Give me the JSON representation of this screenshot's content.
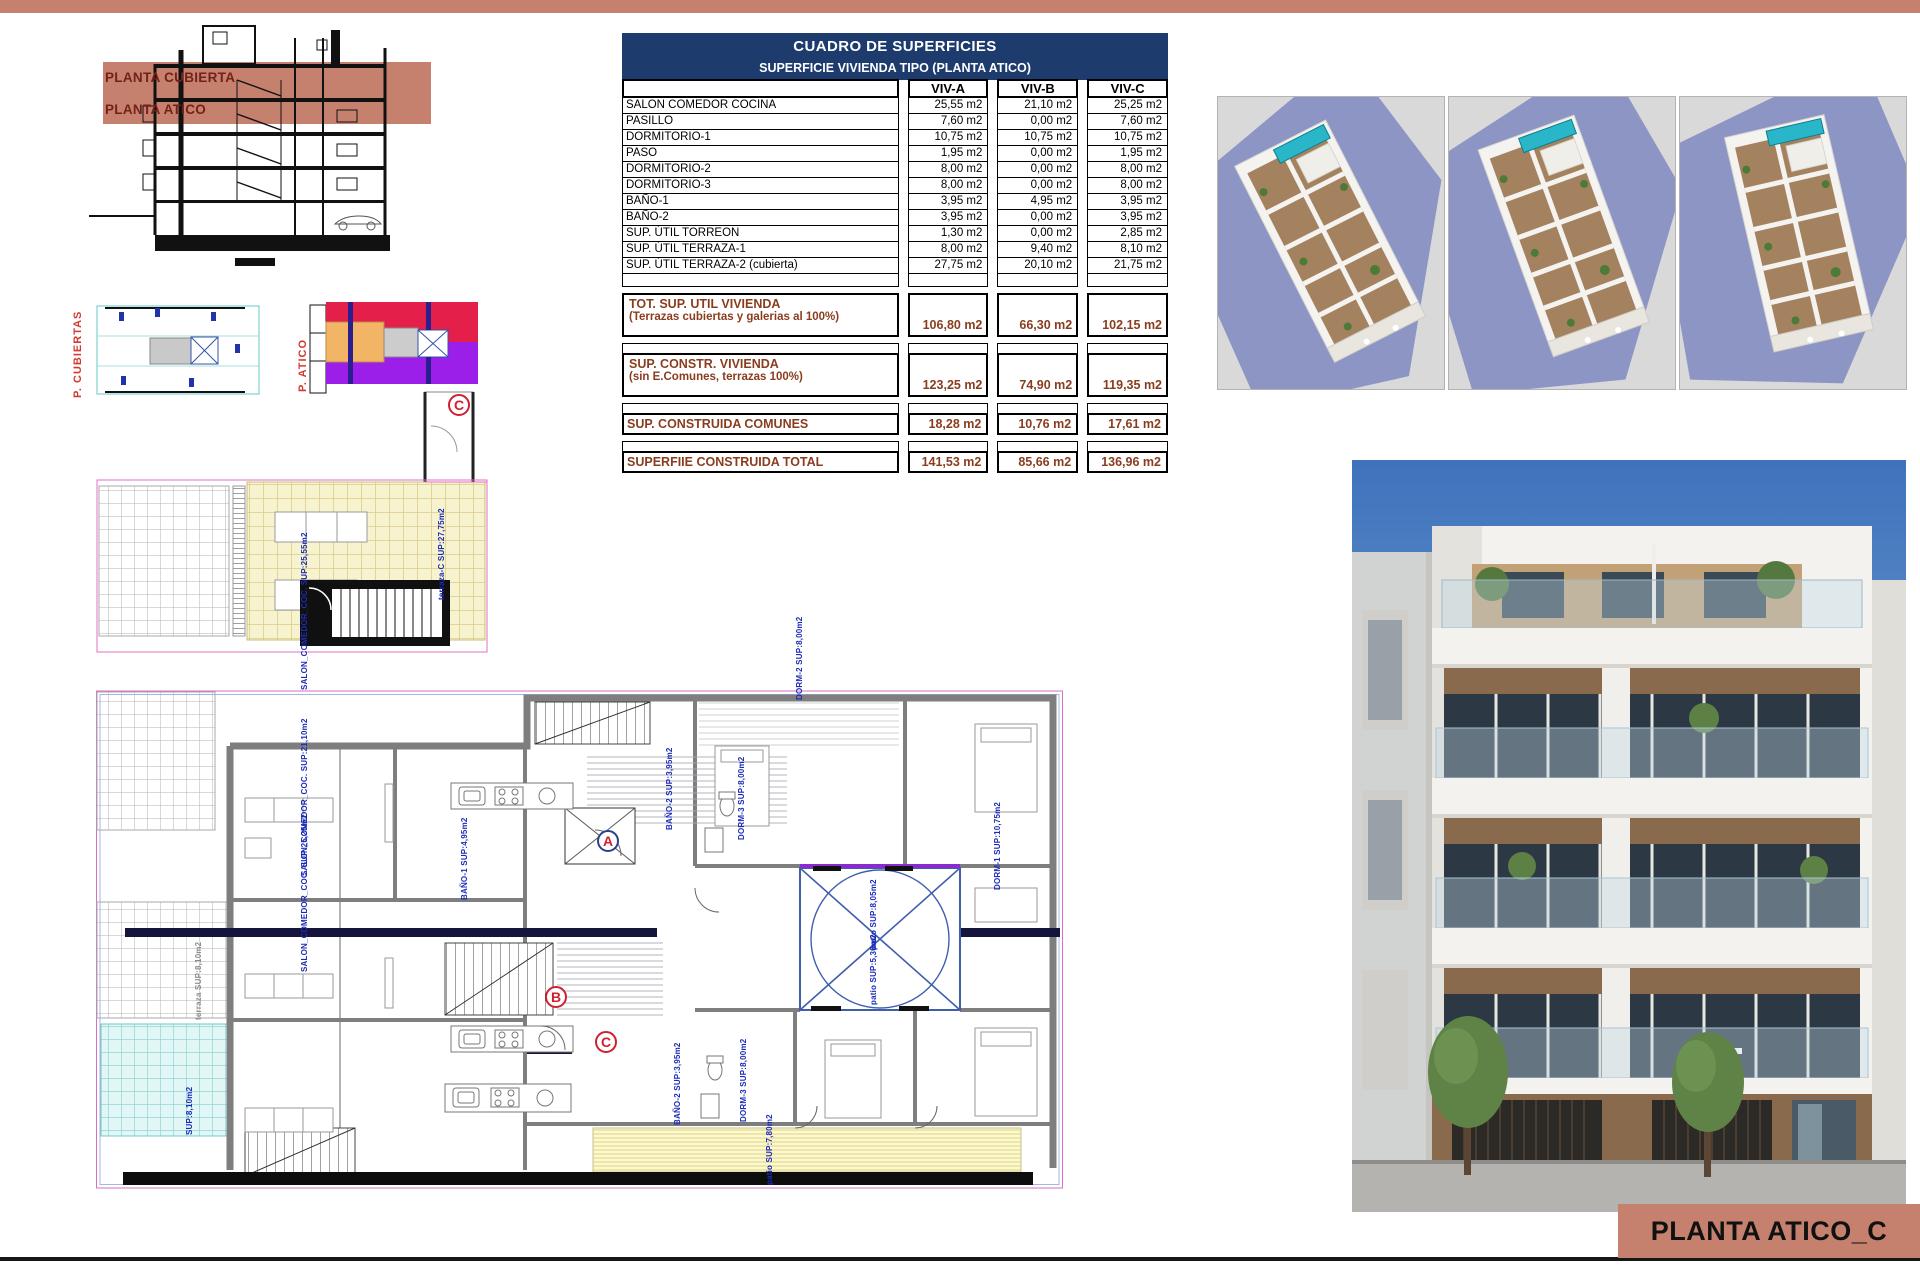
{
  "sheet": {
    "title_box": "PLANTA ATICO_C"
  },
  "section_view": {
    "band_label_1": "PLANTA CUBIERTA",
    "band_label_2": "PLANTA ATICO"
  },
  "mini_plans": {
    "left_label": "P. CUBIERTAS",
    "right_label": "P. ATICO"
  },
  "areas_table": {
    "title": "CUADRO DE SUPERFICIES",
    "subtitle": "SUPERFICIE VIVIENDA TIPO (PLANTA ATICO)",
    "columns": [
      "VIV-A",
      "VIV-B",
      "VIV-C"
    ],
    "rows": [
      {
        "label": "SALON COMEDOR COCINA",
        "viv_a": "25,55 m2",
        "viv_b": "21,10 m2",
        "viv_c": "25,25 m2"
      },
      {
        "label": "PASILLO",
        "viv_a": "7,60 m2",
        "viv_b": "0,00 m2",
        "viv_c": "7,60 m2"
      },
      {
        "label": "DORMITORIO-1",
        "viv_a": "10,75 m2",
        "viv_b": "10,75 m2",
        "viv_c": "10,75 m2"
      },
      {
        "label": "PASO",
        "viv_a": "1,95 m2",
        "viv_b": "0,00 m2",
        "viv_c": "1,95 m2"
      },
      {
        "label": "DORMITORIO-2",
        "viv_a": "8,00 m2",
        "viv_b": "0,00 m2",
        "viv_c": "8,00 m2"
      },
      {
        "label": "DORMITORIO-3",
        "viv_a": "8,00 m2",
        "viv_b": "0,00 m2",
        "viv_c": "8,00 m2"
      },
      {
        "label": "BAÑO-1",
        "viv_a": "3,95 m2",
        "viv_b": "4,95 m2",
        "viv_c": "3,95 m2"
      },
      {
        "label": "BAÑO-2",
        "viv_a": "3,95 m2",
        "viv_b": "0,00 m2",
        "viv_c": "3,95 m2"
      },
      {
        "label": "SUP. ÚTIL TORREON",
        "viv_a": "1,30 m2",
        "viv_b": "0,00 m2",
        "viv_c": "2,85 m2"
      },
      {
        "label": "SUP. ÚTIL TERRAZA-1",
        "viv_a": "8,00 m2",
        "viv_b": "9,40 m2",
        "viv_c": "8,10 m2"
      },
      {
        "label": "SUP. ÚTIL TERRAZA-2 (cubierta)",
        "viv_a": "27,75 m2",
        "viv_b": "20,10 m2",
        "viv_c": "21,75 m2"
      }
    ],
    "summary": [
      {
        "l1": "TOT. SUP. UTIL VIVIENDA",
        "l2": "(Terrazas cubiertas y galerias al 100%)",
        "viv_a": "106,80 m2",
        "viv_b": "66,30 m2",
        "viv_c": "102,15 m2"
      },
      {
        "l1": "SUP. CONSTR. VIVIENDA",
        "l2": "(sin E.Comunes, terrazas 100%)",
        "viv_a": "123,25 m2",
        "viv_b": "74,90 m2",
        "viv_c": "119,35 m2"
      },
      {
        "l1": "SUP. CONSTRUIDA COMUNES",
        "viv_a": "18,28 m2",
        "viv_b": "10,76 m2",
        "viv_c": "17,61 m2"
      },
      {
        "l1": "SUPERFIIE CONSTRUIDA TOTAL",
        "viv_a": "141,53 m2",
        "viv_b": "85,66 m2",
        "viv_c": "136,96 m2"
      }
    ]
  },
  "roof_terrace_plan": {
    "marker": "C",
    "label": "terraza-C SUP:27,75m2"
  },
  "main_plan": {
    "markers": [
      {
        "label": "A"
      },
      {
        "label": "B"
      },
      {
        "label": "C"
      }
    ],
    "labels": [
      "SALON_COMEDOR_COC. SUP:25,55m2",
      "SALON_COMEDOR_COC. SUP:21,10m2",
      "SALON_COMEDOR_COC. SUP:25,25m2",
      "BAÑO-1 SUP:4,95m2",
      "BAÑO-2 SUP:3,95m2",
      "DORM-3 SUP:8,00m2",
      "DORM-1 SUP:10,75m2",
      "patio SUP:8,05m2",
      "patio SUP:5,30m2",
      "BAÑO-2 SUP:3,95m2",
      "DORM-3 SUP:8,00m2",
      "patio SUP:7,80m2",
      "DORM-2 SUP:8,00m2",
      "terraza SUP:8,10m2",
      "SUP:8,10m2"
    ]
  },
  "colors": {
    "accent_salmon": "#c5816e",
    "table_header_navy": "#1d3b6d",
    "summary_text_red": "#8a3c1e",
    "annotation_blue": "#1b2bb8",
    "marker_red": "#cf2030",
    "patio_blue": "#3f5fae",
    "mini_red": "#e41f4a",
    "mini_purple": "#9b1fe8",
    "mini_orange": "#f2b566",
    "pool_teal": "#28b6c8"
  }
}
